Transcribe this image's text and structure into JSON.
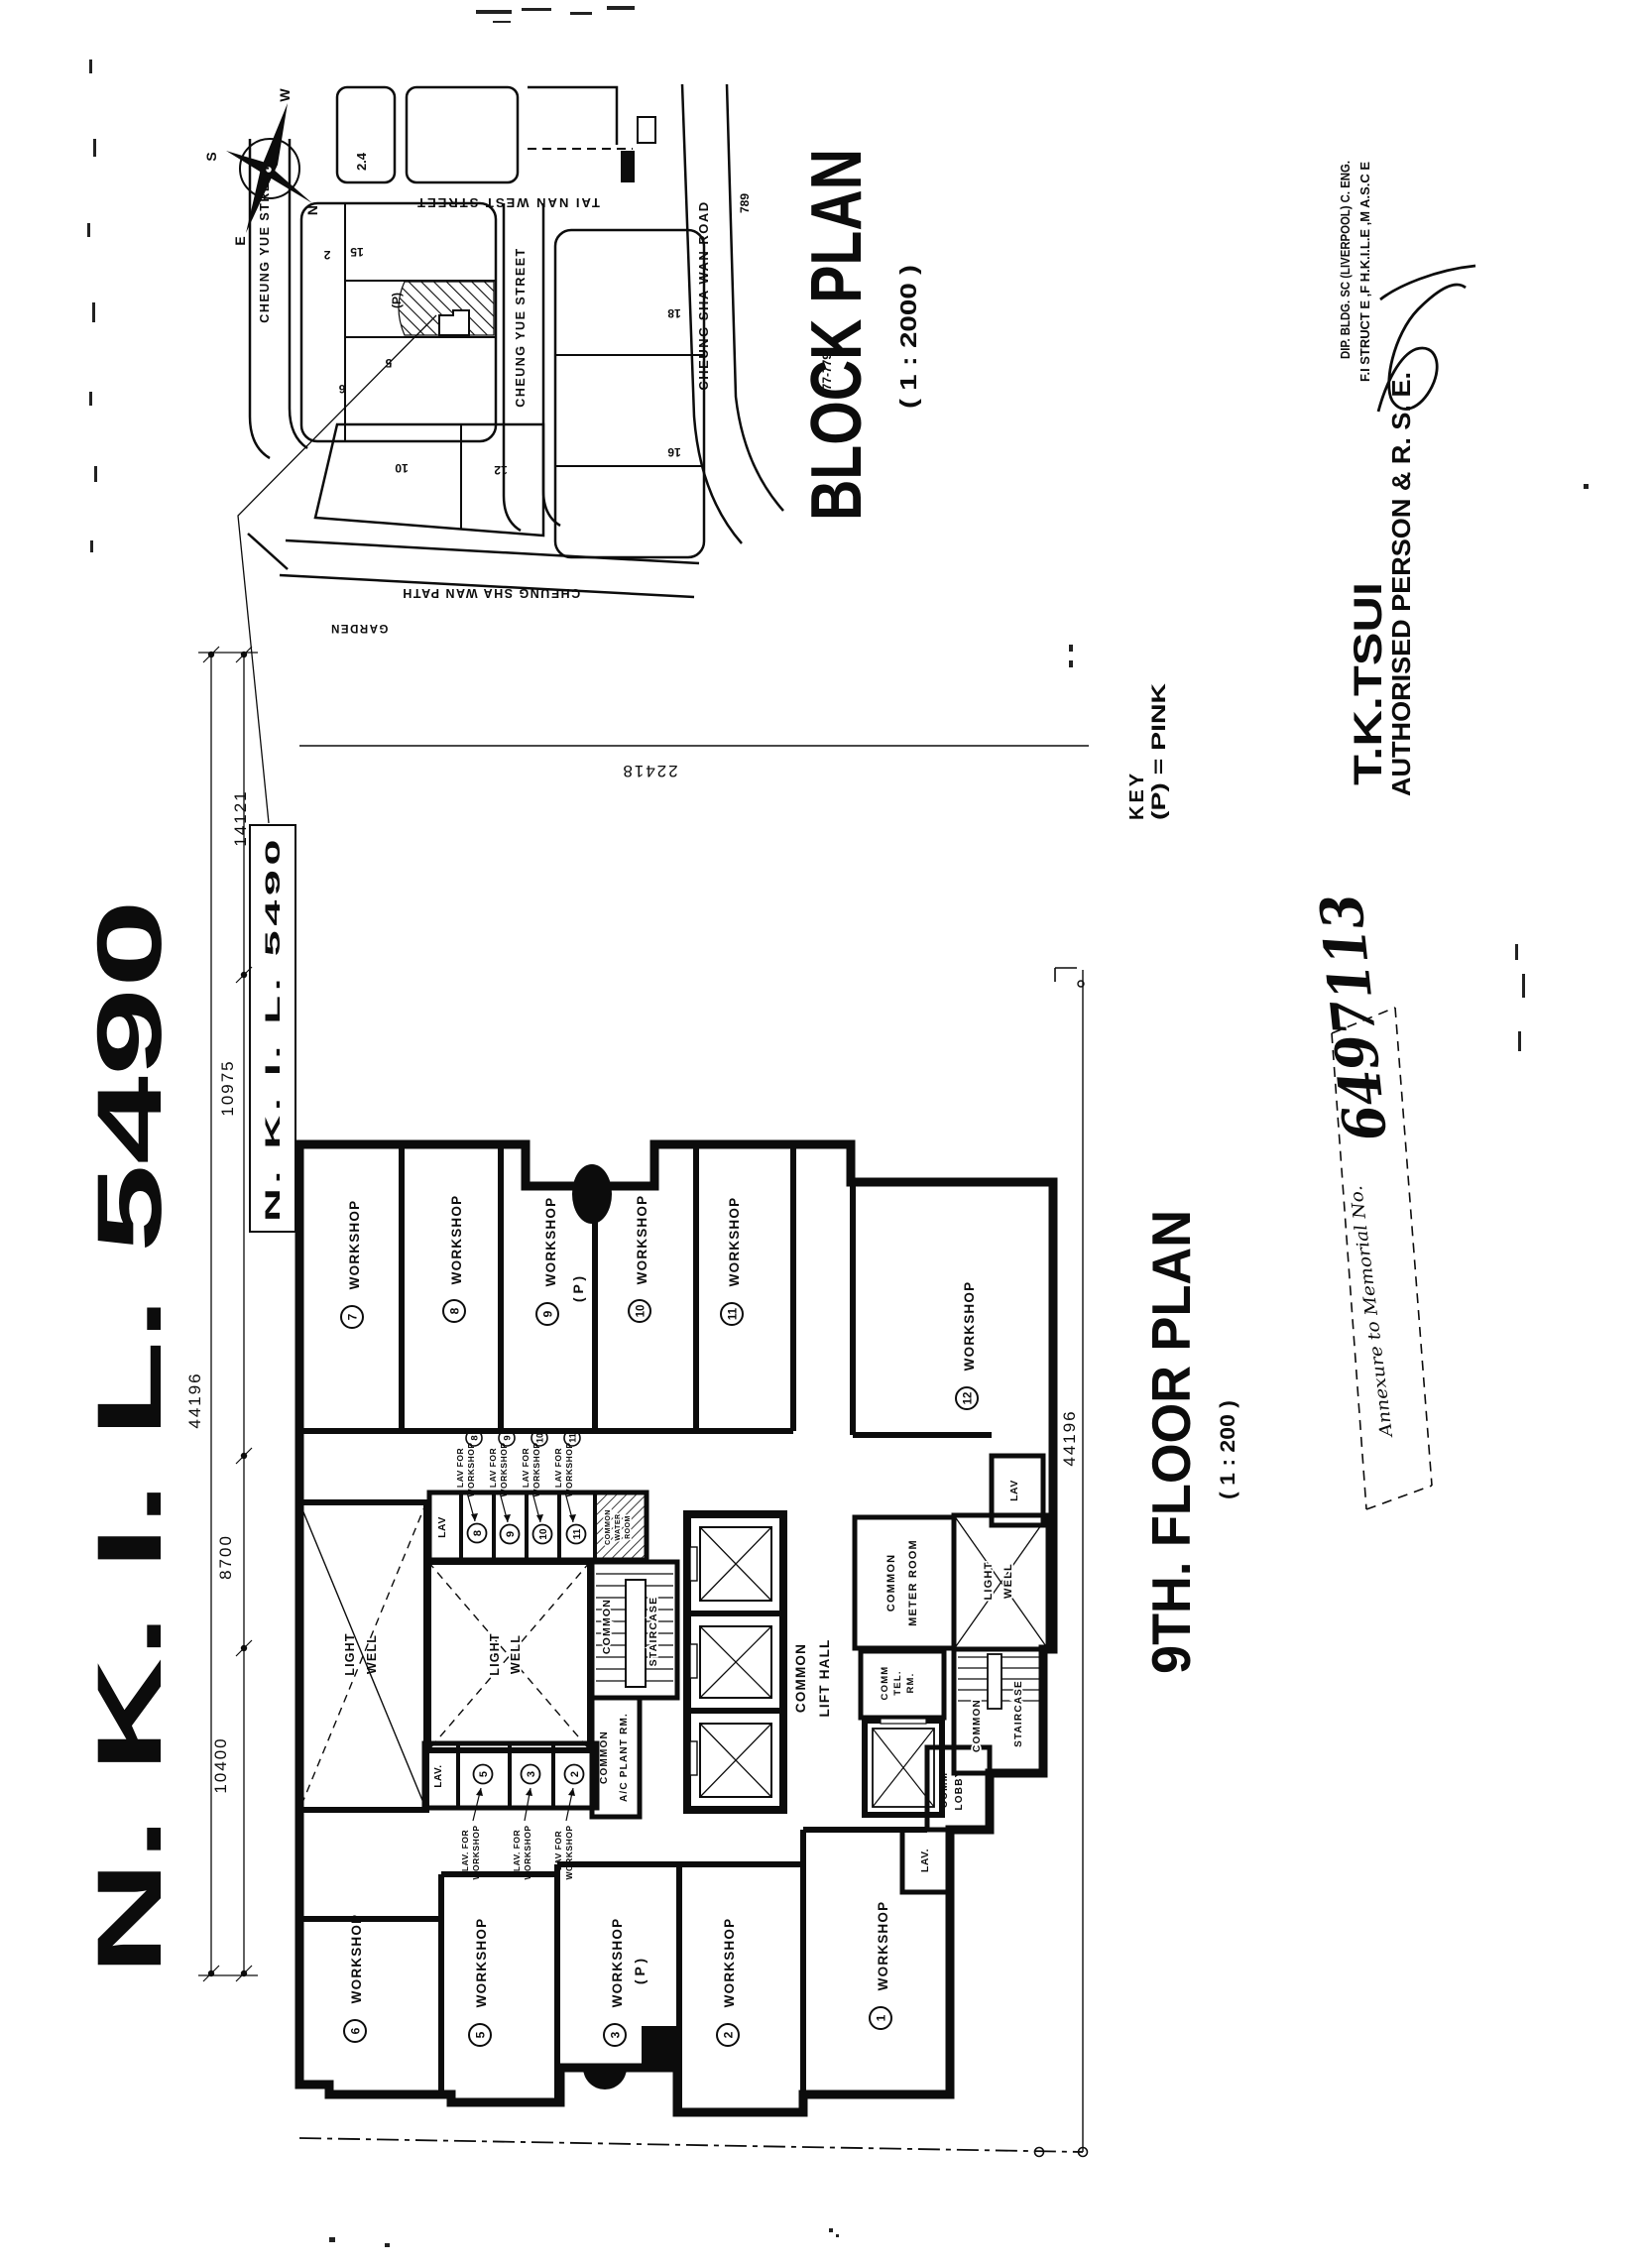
{
  "sheet": {
    "lot_title": "N.  K.  I.  L.   5490",
    "ink": "#0c0c0c",
    "paper": "#ffffff"
  },
  "block_plan": {
    "title": "BLOCK PLAN",
    "scale": "( 1 : 2000 )",
    "compass": {
      "n": "N",
      "s": "S",
      "e": "E",
      "w": "W"
    },
    "streets": {
      "tai_nan_west": "TAI NAN WEST STREET",
      "cheung_yue_west": "CHEUNG YUE STREET",
      "cheung_yue_east": "CHEUNG YUE STREET",
      "cheung_sha_wan_road": "CHEUNG SHA WAN ROAD",
      "cheung_sha_wan_path": "CHEUNG SHA WAN PATH",
      "garden": "GARDEN"
    },
    "lots": {
      "l24": "2.4",
      "l2": "2",
      "l15": "15",
      "l5": "5",
      "l6": "6",
      "site_mark": "(P)",
      "l18": "18",
      "l16": "16",
      "l10": "10",
      "l12": "12",
      "l789": "789",
      "l777": "777-779"
    },
    "site_ref_label": "N. K. I. L.  5490"
  },
  "floor_plan": {
    "title": "9TH.  FLOOR  PLAN",
    "scale": "( 1 : 200 )",
    "key": {
      "label": "KEY",
      "value": "(P)  =  PINK"
    },
    "workshop_word": "WORKSHOP",
    "pink_mark": "( P )",
    "workshops": [
      {
        "no": "7"
      },
      {
        "no": "8"
      },
      {
        "no": "9"
      },
      {
        "no": "10"
      },
      {
        "no": "11"
      },
      {
        "no": "12"
      },
      {
        "no": "6"
      },
      {
        "no": "5"
      },
      {
        "no": "3"
      },
      {
        "no": "2"
      },
      {
        "no": "1"
      }
    ],
    "rooms": {
      "light": "LIGHT",
      "well": "WELL",
      "common": "COMMON",
      "lift_hall": "LIFT  HALL",
      "staircase": "STAIRCASE",
      "ac_plant": "A/C PLANT RM.",
      "meter_room": "METER ROOM",
      "water": "WATER",
      "room": "ROOM",
      "comm": "COMM",
      "tel": "TEL.",
      "rm": "RM.",
      "lobby": "LOBBY",
      "lav": "LAV",
      "lav_dot": "LAV."
    },
    "lav_labels": {
      "line1": "LAV FOR",
      "line1_dot": "LAV. FOR",
      "line2": "WORKSHOP",
      "upper": [
        "8",
        "9",
        "10",
        "11"
      ],
      "lower": [
        "5",
        "3",
        "2"
      ]
    },
    "dims": {
      "left_total": "44196",
      "seg1": "14121",
      "seg2": "10975",
      "seg3": "8700",
      "seg4": "10400",
      "top": "22418",
      "right_total": "44196"
    }
  },
  "signatory": {
    "name": "T.K.TSUI",
    "credential_1": "DIP. BLDG.  SC  (LIVERPOOL)  C. ENG.",
    "credential_2": "F.I STRUCT E ,F H.K.I.L.E ,M A.S.C E",
    "role": "AUTHORISED  PERSON  &  R.  S.  E."
  },
  "stamp": {
    "label": "Annexure to Memorial No.",
    "number": "6497113"
  }
}
